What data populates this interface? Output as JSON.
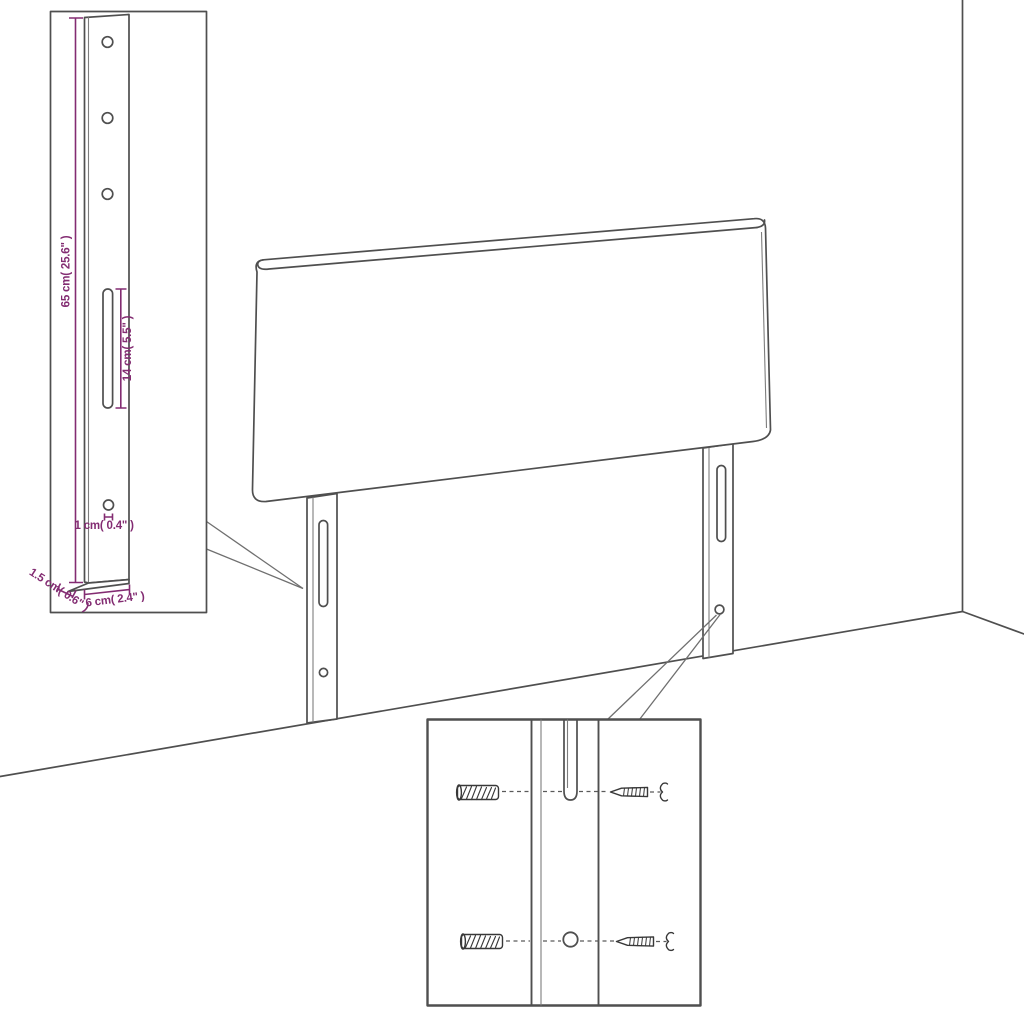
{
  "colors": {
    "line": "#4f4f4f",
    "dimension": "#832c72",
    "background": "#ffffff"
  },
  "dimensions": {
    "leg_height": "65 cm( 25.6\" )",
    "slot_length": "14 cm( 5.5\" )",
    "hole_diameter": "1 cm( 0.4\" )",
    "leg_thickness": "1.5 cm( 0.6\" )",
    "leg_width": "6 cm( 2.4\" )"
  },
  "icons": {
    "wall_plug": "wall-plug-icon",
    "screw": "screw-icon"
  }
}
